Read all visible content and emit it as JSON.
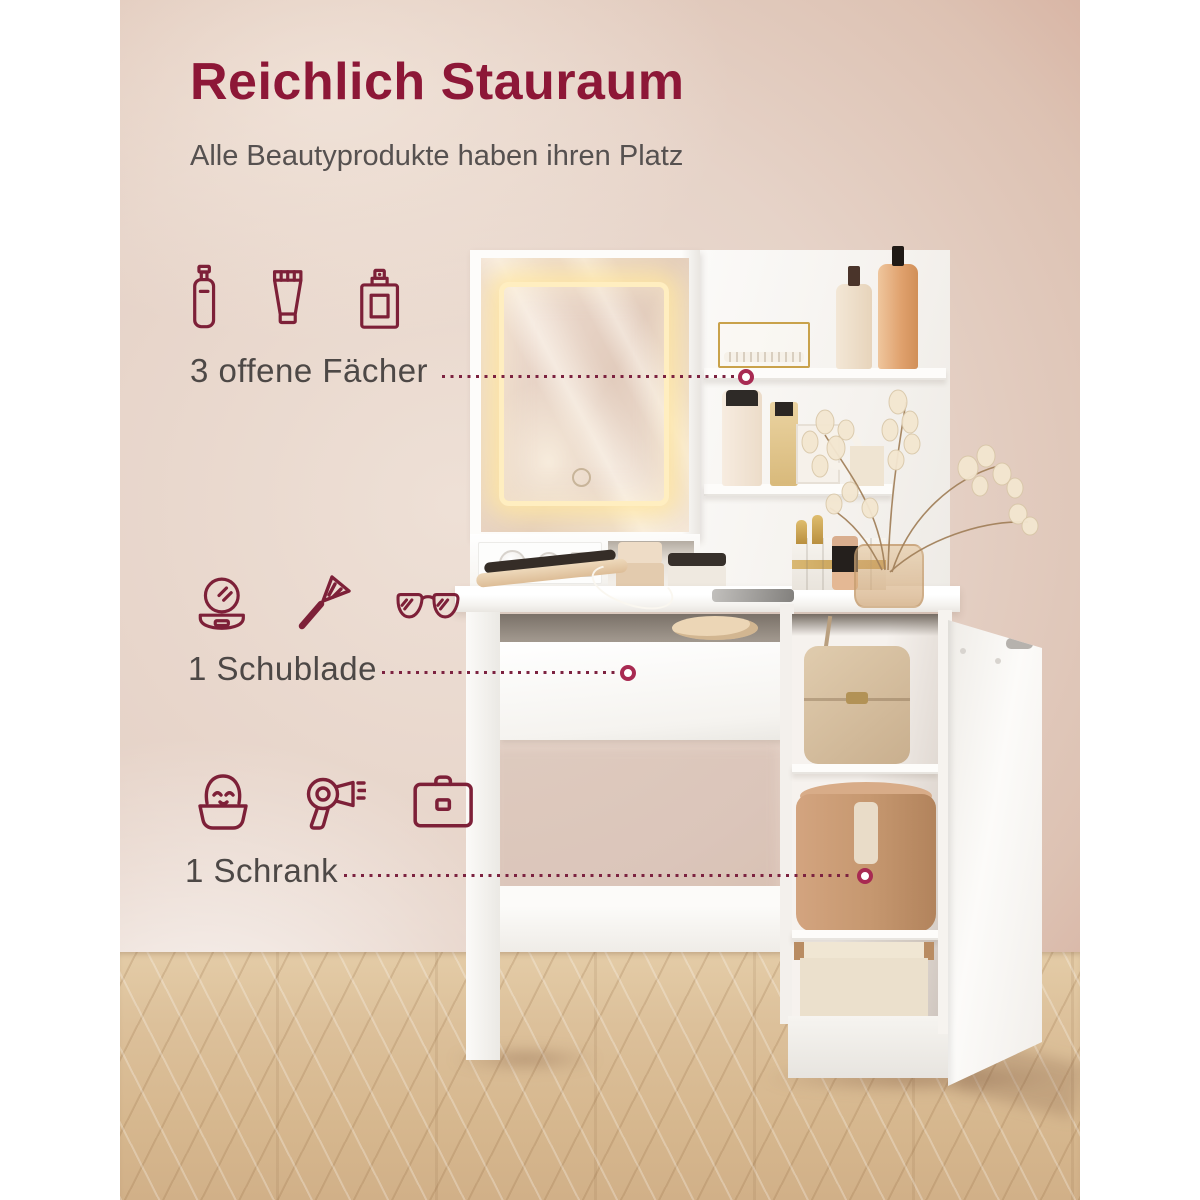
{
  "header": {
    "title": "Reichlich Stauraum",
    "subtitle": "Alle Beautyprodukte haben ihren Platz"
  },
  "features": [
    {
      "label": "3 offene Fächer",
      "icons": [
        "lotion-bottle-icon",
        "cream-tube-icon",
        "perfume-bottle-icon"
      ]
    },
    {
      "label": "1 Schublade",
      "icons": [
        "compact-mirror-icon",
        "makeup-brush-icon",
        "sunglasses-icon"
      ]
    },
    {
      "label": "1 Schrank",
      "icons": [
        "face-care-icon",
        "hair-dryer-icon",
        "briefcase-icon"
      ]
    }
  ],
  "colors": {
    "accent": "#8d1737",
    "icon_stroke": "#7d2038",
    "label_text": "#4d4846",
    "dotted_line": "#7c2240",
    "ring": "#a82a52"
  }
}
